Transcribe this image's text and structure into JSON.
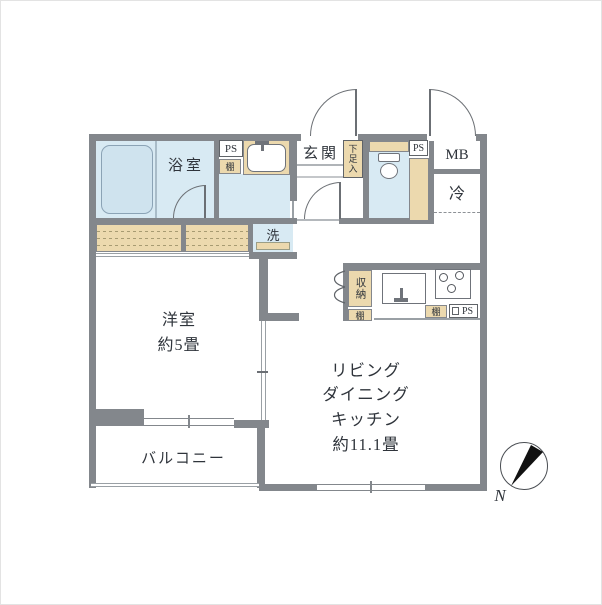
{
  "colors": {
    "wall": "#83878c",
    "water_room_fill": "#d8eaf3",
    "cabinet_tan": "#ecd9ae",
    "thin_line": "#9aa0a5",
    "text": "#2f343b",
    "compass_needle": "#111111"
  },
  "labels": {
    "bathroom": "浴室",
    "ps_top": "PS",
    "shelf_bath": "棚",
    "laundry": "洗",
    "entrance": "玄関",
    "shoe_cabinet": "下足入",
    "ps_toilet": "PS",
    "meter_box": "MB",
    "refrigerator": "冷",
    "storage": "収納",
    "shelf_kitchen_left": "棚",
    "shelf_kitchen_right": "棚",
    "ps_kitchen": "PS",
    "western_room": "洋室",
    "western_room_size": "約5畳",
    "ldk_1": "リビング",
    "ldk_2": "ダイニング",
    "ldk_3": "キッチン",
    "ldk_4": "約11.1畳",
    "balcony": "バルコニー",
    "north": "N"
  }
}
